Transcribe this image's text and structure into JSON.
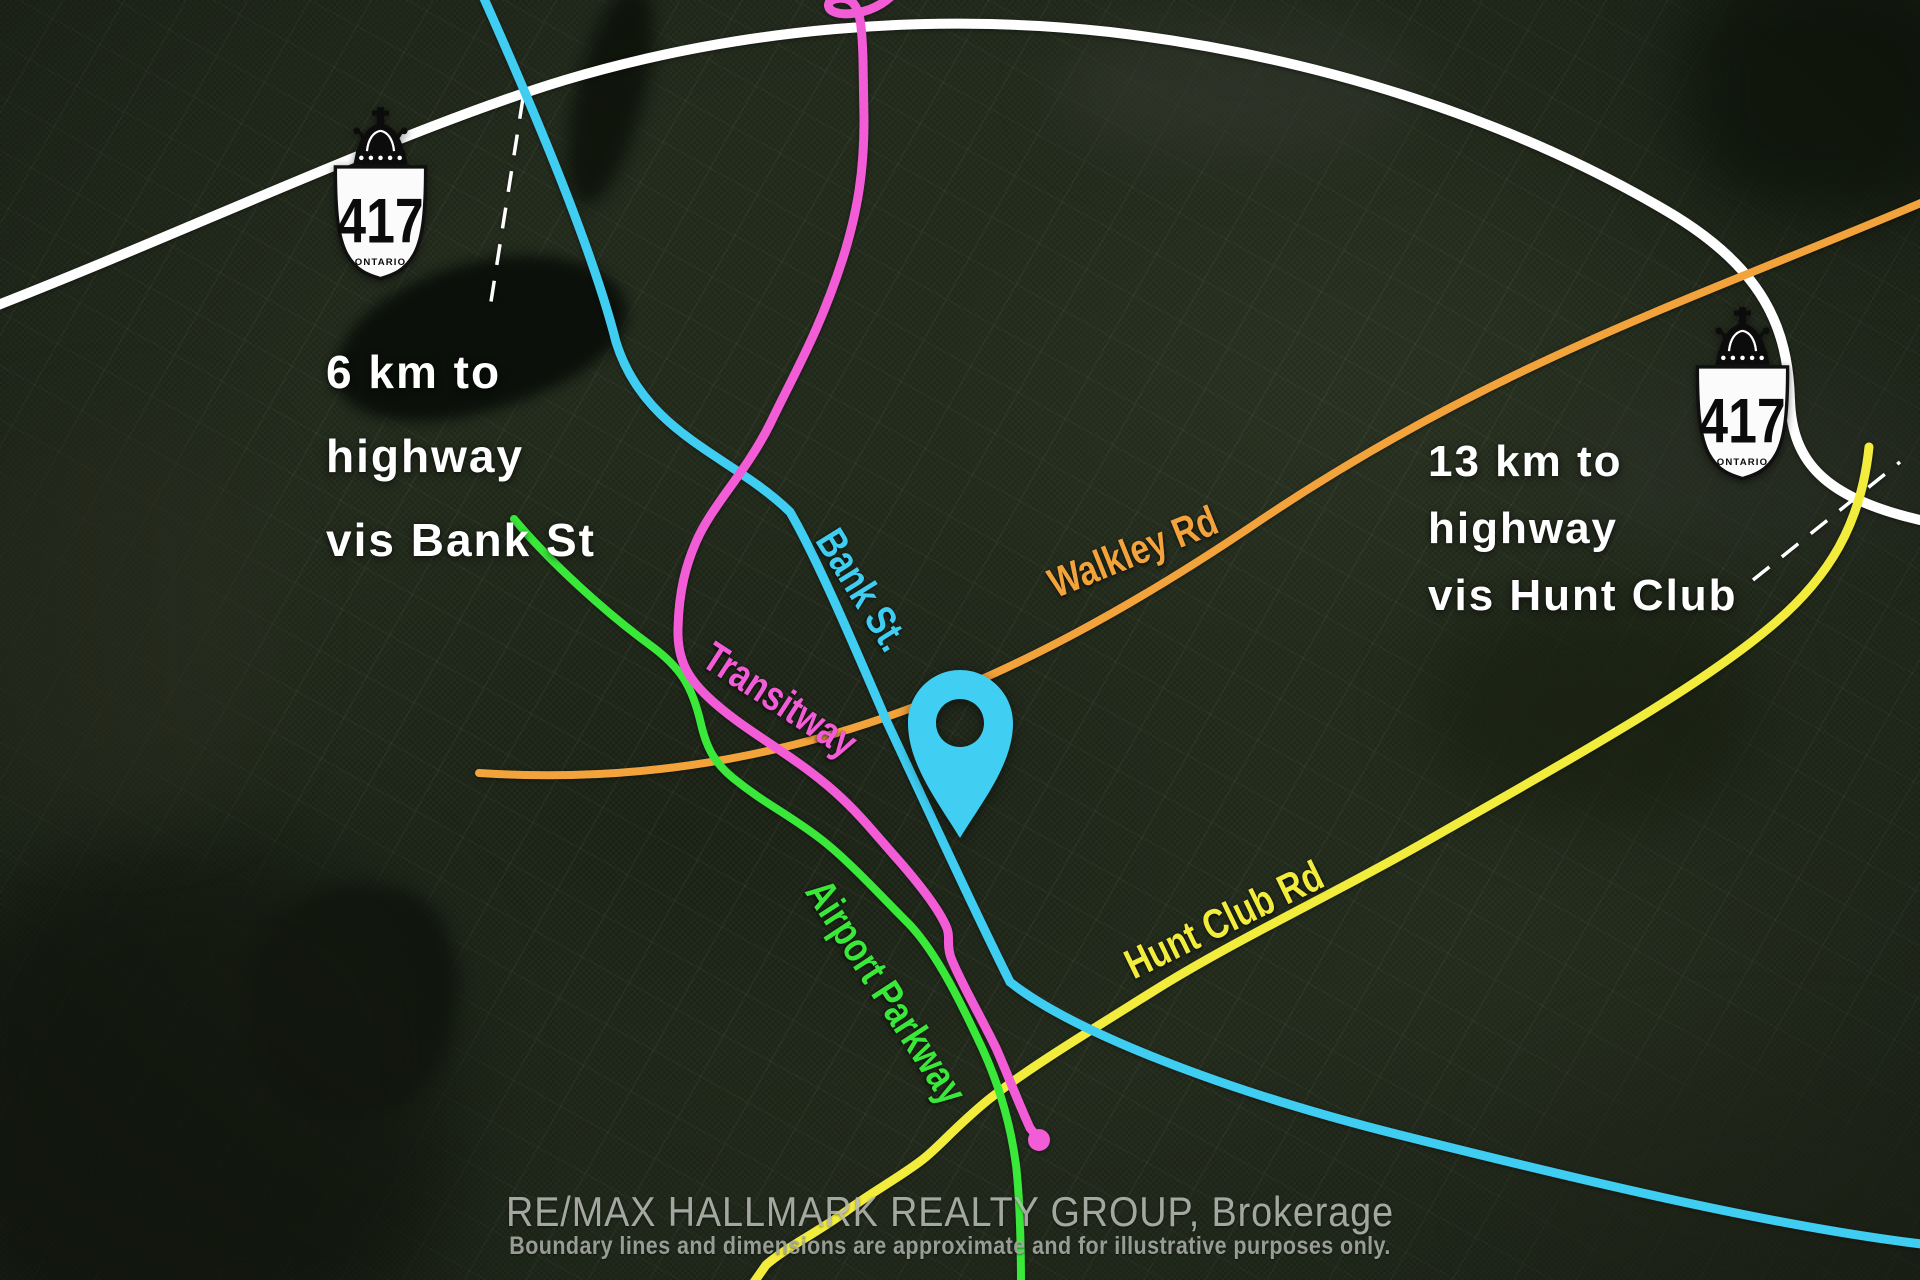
{
  "annotations": {
    "left": {
      "lines": [
        "6 km to",
        "highway",
        "vis Bank St"
      ]
    },
    "right": {
      "lines": [
        "13 km to",
        "highway",
        "vis Hunt Club"
      ]
    }
  },
  "road_labels": {
    "bank_st": "Bank St.",
    "transitway": "Transitway",
    "walkley_rd": "Walkley Rd",
    "airport_parkway": "Airport Parkway",
    "hunt_club_rd": "Hunt Club Rd"
  },
  "highway_shield": {
    "route": "417",
    "province": "ONTARIO"
  },
  "footer": {
    "brokerage": "RE/MAX HALLMARK REALTY GROUP, Brokerage",
    "disclaimer": "Boundary lines and dimensions are approximate and for illustrative purposes only."
  },
  "colors": {
    "bank_st_cyan": "#3FCDF2",
    "transitway_magenta": "#F25CD6",
    "walkley_orange": "#F3A33B",
    "airport_parkway_green": "#39E839",
    "hunt_club_yellow": "#F2EC3D",
    "highway_white": "#FFFFFF",
    "pin_cyan": "#41CEF3"
  }
}
